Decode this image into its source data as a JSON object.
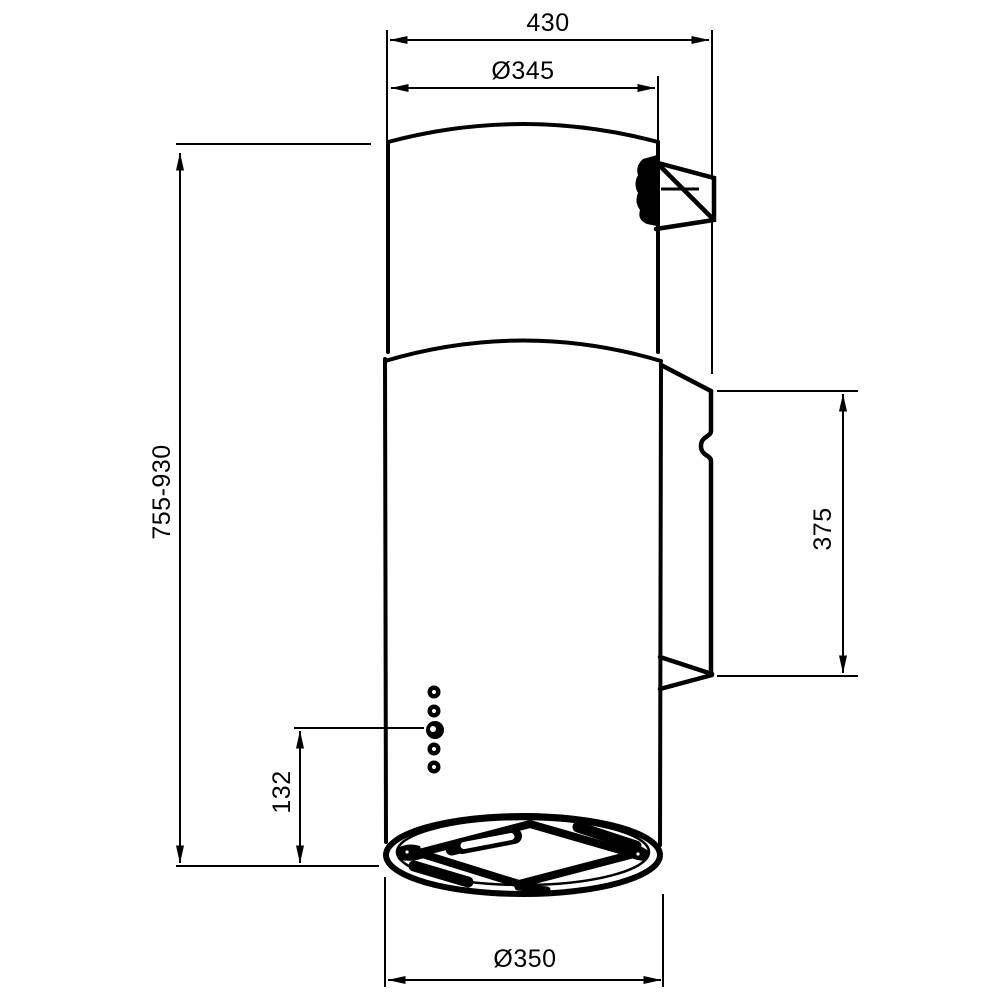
{
  "drawing": {
    "colors": {
      "line": "#000000",
      "background": "#ffffff"
    },
    "dimensions": {
      "overall_width": {
        "label": "430"
      },
      "top_diameter": {
        "label": "Ø345"
      },
      "height_range": {
        "label": "755-930"
      },
      "bracket_height": {
        "label": "375"
      },
      "controls_offset": {
        "label": "132"
      },
      "body_diameter": {
        "label": "Ø350"
      }
    }
  }
}
